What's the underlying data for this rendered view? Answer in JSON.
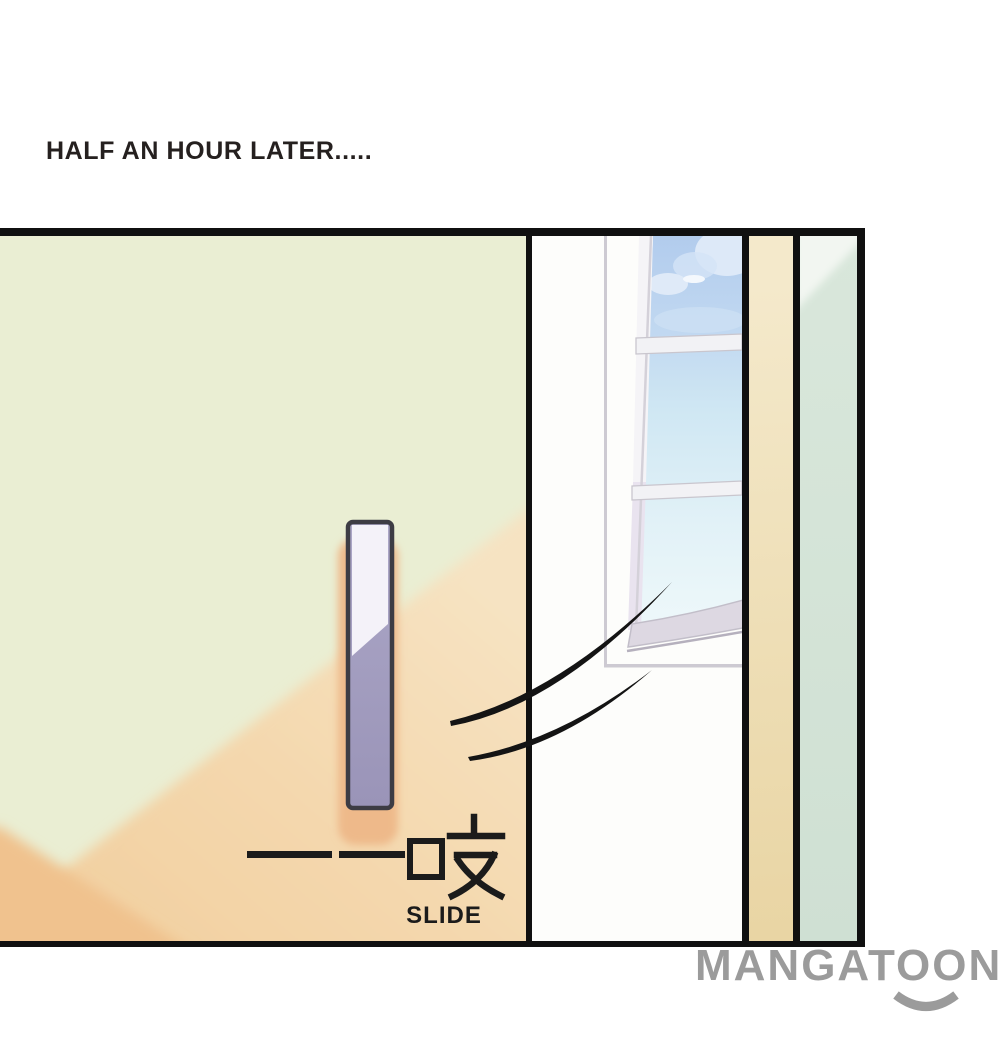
{
  "page": {
    "width": 1000,
    "height": 1061,
    "background": "#ffffff"
  },
  "caption": {
    "text": "HALF AN HOUR LATER.....",
    "color": "#25201f"
  },
  "panel": {
    "description": "Manga panel: cream sliding door with lavender handle gliding open beside a sunlit window",
    "border_color": "#101010",
    "door": {
      "base_color": "#eaeed3",
      "shade_color": "#f4d8ae",
      "corner_shade_color": "#f0c28e",
      "handle_fill": "#a5a0c2",
      "handle_highlight": "#f4f2f9",
      "handle_border": "#3d3c44",
      "handle_shadow": "#eeb98a"
    },
    "window": {
      "wall_color": "#fdfdfb",
      "frame_line_color": "#cdcad2",
      "open_pane_color": "#ddd8e2",
      "sky_top_color": "#b2cced",
      "sky_bottom_color": "#eef8fa",
      "cloud_color": "#dde9f8"
    },
    "right_wall": {
      "tan_strip_color": "#ecd9ab",
      "mint_strip_color": "#d5e3d7",
      "mint_highlight_color": "#f2f6f1"
    },
    "sfx": {
      "dash": "——",
      "cjk": "吱",
      "label": "SLIDE",
      "color": "#1b1b1b"
    }
  },
  "watermark": {
    "text": "MANGATOON",
    "color": "#9b9b9b"
  }
}
